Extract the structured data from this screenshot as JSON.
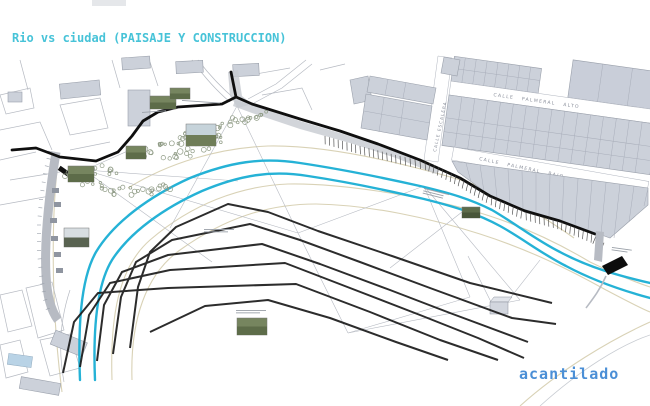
{
  "title": {
    "text": "Rio vs ciudad (PAISAJE Y CONSTRUCCION)"
  },
  "labels": {
    "acantilado": "acantilado",
    "street_alto": "CALLE PALMERAL ALTO",
    "street_bajo": "CALLE PALMERAL BAJO",
    "street_escalera": "CALLE ESCALERA"
  },
  "colors": {
    "title_text": "#47c3d8",
    "acantilado_text": "#4b8fd6",
    "river": "#25b2d6",
    "buildings": "#ccd1da",
    "building_outline": "#9aa0ab",
    "contour_black": "#1b1b1b",
    "terrain_tan": "#d9d2b6",
    "road_band": "#b7bbc3"
  }
}
